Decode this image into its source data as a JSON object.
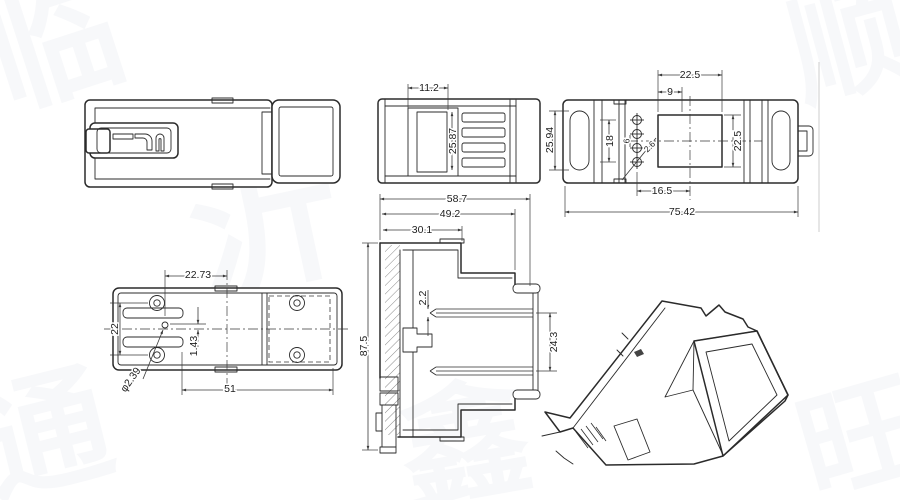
{
  "drawing": {
    "type": "multi-view technical drawing of DIN-rail enclosure / connector housing"
  },
  "dims": {
    "front": {
      "width": "11.2",
      "height": "25.87"
    },
    "top": {
      "window_width": "22.5",
      "offset": "9",
      "ear_slot_height": "25.94",
      "terminal_span": "18",
      "hole_pitch": "6",
      "hole_note": "2.6",
      "hole_offset": "16.5",
      "overall_width": "75.42",
      "window_height": "22.5"
    },
    "section": {
      "overall_width": "58.7",
      "mid_width": "49.2",
      "inner_width": "30.1",
      "pin_thickness": "2.2",
      "overall_height": "87.5",
      "pin_span": "24.3"
    },
    "bottom": {
      "boss_offset": "22.73",
      "boss_pitch_vertical": "22",
      "pin_offset": "1.43",
      "hole_diameter": "φ2.39",
      "boss_pitch_horizontal": "51"
    }
  },
  "watermarks": [
    "临",
    "沂",
    "顺",
    "通",
    "鑫",
    "旺"
  ]
}
